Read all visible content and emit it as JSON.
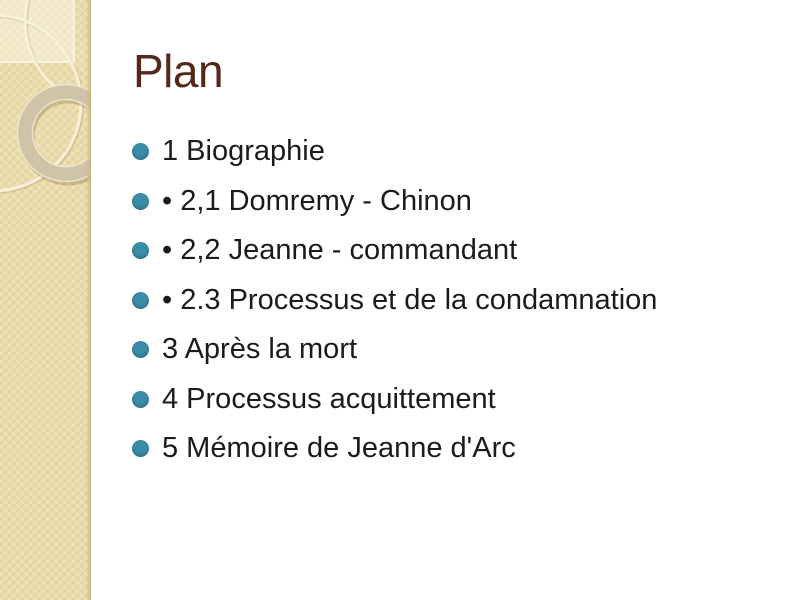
{
  "slide": {
    "title": "Plan",
    "bullets": [
      "1 Biographie",
      "• 2,1 Domremy - Chinon",
      "• 2,2 Jeanne - commandant",
      "• 2.3 Processus et de la condamnation",
      "3 Après la mort",
      "4 Processus acquittement",
      "5 Mémoire de Jeanne d'Arc"
    ]
  },
  "colors": {
    "bullet-accent": "#3A8CA8",
    "title-color": "#54281B",
    "body-text": "#1B1B1B",
    "strip-beige": "#EBDCAC",
    "strip-edge": "#C9B685",
    "ornament-light": "#F7F0DA",
    "donut-ring": "#CFC4AA",
    "background": "#FFFFFF"
  }
}
